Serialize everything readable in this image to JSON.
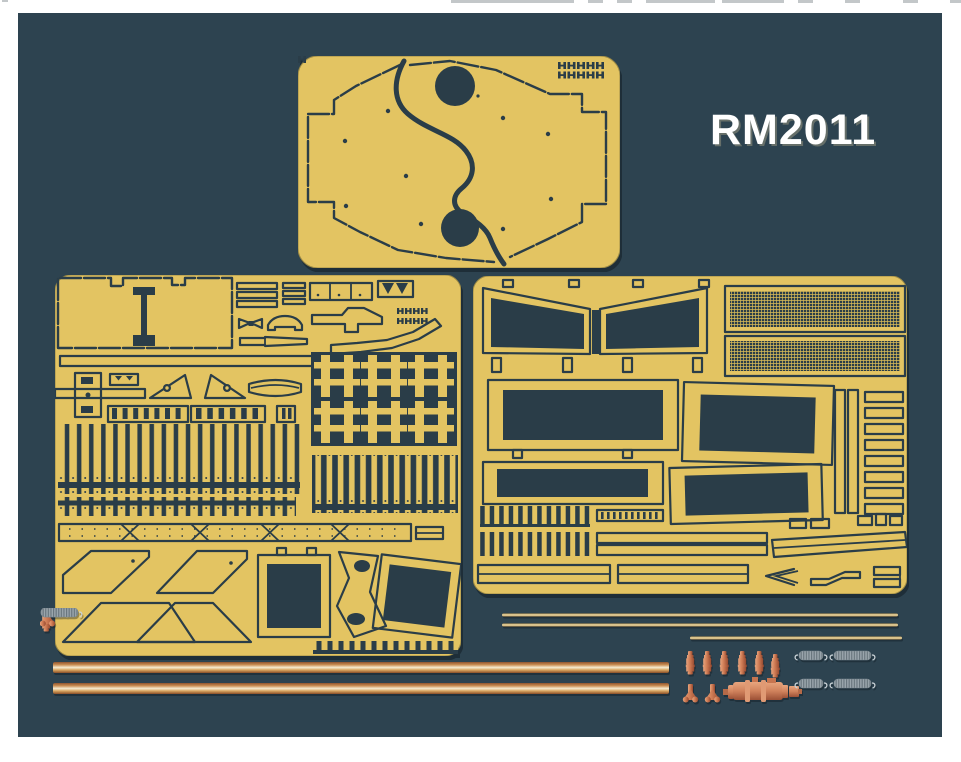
{
  "label": {
    "text": "RM2011"
  },
  "colors": {
    "page_bg": "#ffffff",
    "panel_bg": "#2d4350",
    "fret_brass": "#e3c462",
    "fret_edge": "#9c8a46",
    "etch_dark": "#2a3d48",
    "mesh_line": "#d9bb57",
    "label_text": "#ffffff",
    "crop_mark": "#b9bdc0",
    "copper_rod_light": "#f6ecd2",
    "copper_rod": "#c98d52",
    "copper_rod_dark": "#8a4e28",
    "wire_brass": "#e6d29b",
    "part_copper": "#d0825c",
    "part_copper_light": "#e8a57e",
    "part_copper_dark": "#96492f",
    "spring_silver": "#9aa5ac",
    "spring_coil_dark": "#66737b"
  },
  "frets": {
    "top": {
      "name": "fender-plates-fret",
      "parts": [
        "left-fender-plate",
        "right-fender-plate",
        "hinge-slot-grid"
      ]
    },
    "left": {
      "name": "hull-detail-fret",
      "parts": [
        "large-bin-panel",
        "strip-stacks",
        "clamp-row",
        "track-link-lattice",
        "fender-slat-rows",
        "segmented-skirt-strip",
        "angled-hull-plates",
        "box-frames"
      ]
    },
    "right": {
      "name": "engine-deck-fret",
      "parts": [
        "intake-grille-frames",
        "mesh-screens",
        "engine-deck-grille-frames",
        "side-strip-stack",
        "louver-slats",
        "tow-brackets"
      ]
    }
  },
  "hardware": {
    "brass_rods": {
      "count": 2
    },
    "brass_wires": {
      "count": 3
    },
    "turned_barrels": {
      "count": 6
    },
    "mount_feet": {
      "count": 2
    },
    "turned_muffler": {
      "count": 1
    },
    "coil_springs": {
      "count": 4
    }
  }
}
